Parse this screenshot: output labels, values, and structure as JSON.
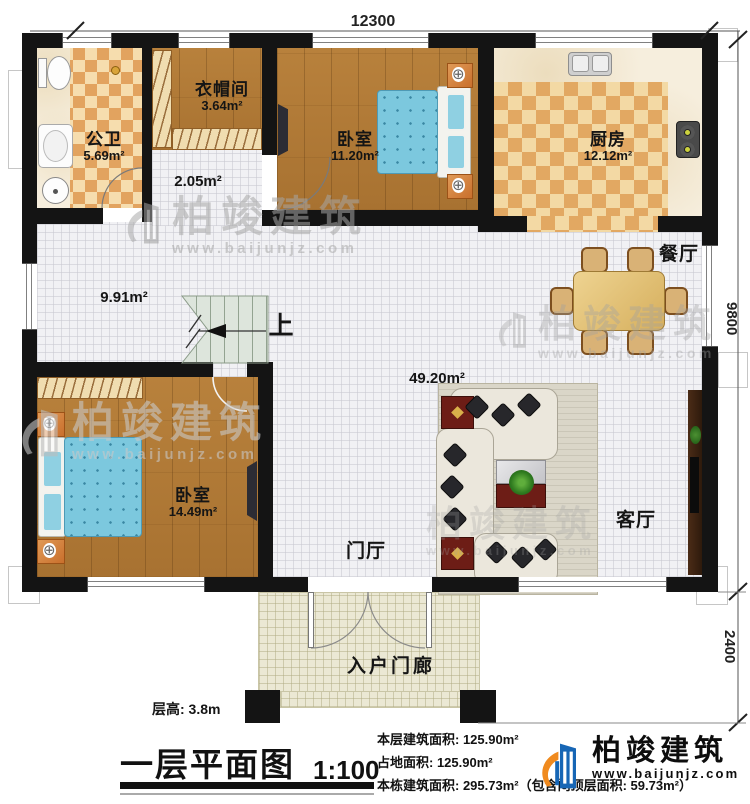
{
  "watermark": {
    "name": "柏竣建筑",
    "url": "www.baijunjz.com"
  },
  "logo": {
    "name": "柏竣建筑",
    "url": "www.baijunjz.com"
  },
  "dimensions": {
    "top": "12300",
    "right_upper": "9800",
    "right_lower": "2400"
  },
  "rooms": {
    "bathroom": {
      "name": "公卫",
      "area": "5.69m²"
    },
    "cloakroom": {
      "name": "衣帽间",
      "area": "3.64m²"
    },
    "hall": {
      "area": "2.05m²"
    },
    "bedroom1": {
      "name": "卧室",
      "area": "11.20m²"
    },
    "kitchen": {
      "name": "厨房",
      "area": "12.12m²"
    },
    "corridor": {
      "area": "9.91m²"
    },
    "stairs": {
      "up_label": "上"
    },
    "dining": {
      "name": "餐厅"
    },
    "open_area": {
      "area": "49.20m²"
    },
    "foyer": {
      "name": "门厅"
    },
    "living": {
      "name": "客厅"
    },
    "bedroom2": {
      "name": "卧室",
      "area": "14.49m²"
    },
    "porch": {
      "name": "入户门廊"
    }
  },
  "title_block": {
    "floor_height": "层高: 3.8m",
    "title": "一层平面图",
    "scale": "1:100",
    "stats": [
      "本层建筑面积: 125.90m²",
      "占地面积: 125.90m²",
      "本栋建筑面积: 295.73m²（包含闷顶层面积: 59.73m²）"
    ]
  },
  "colors": {
    "wall": "#141414",
    "logo_blue": "#1766b5",
    "logo_orange": "#f08a1e",
    "bed_blue": "#7cc8de"
  }
}
